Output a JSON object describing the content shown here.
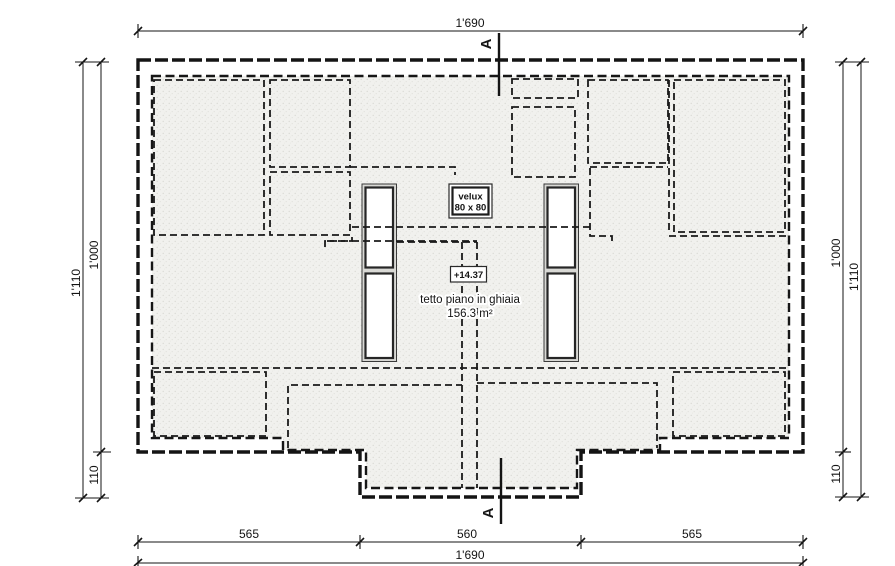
{
  "drawing": {
    "section_marker": "A",
    "annotations": {
      "velux_name": "velux",
      "velux_size": "80 x 80",
      "level": "+14.37",
      "roof_label": "tetto piano in ghiaia",
      "roof_area": "156.3 m²"
    },
    "dimensions": {
      "top_total": "1'690",
      "bottom_total": "1'690",
      "bottom_segments": [
        "565",
        "560",
        "565"
      ],
      "left_outer": "1'110",
      "left_inner": "1'000",
      "left_step": "110",
      "right_outer": "1'110",
      "right_inner": "1'000",
      "right_step": "110"
    },
    "colors": {
      "line": "#141414",
      "hatch_background": "#f1f1ee",
      "hatch_dot": "#d9d9d4",
      "paper": "#ffffff"
    }
  }
}
